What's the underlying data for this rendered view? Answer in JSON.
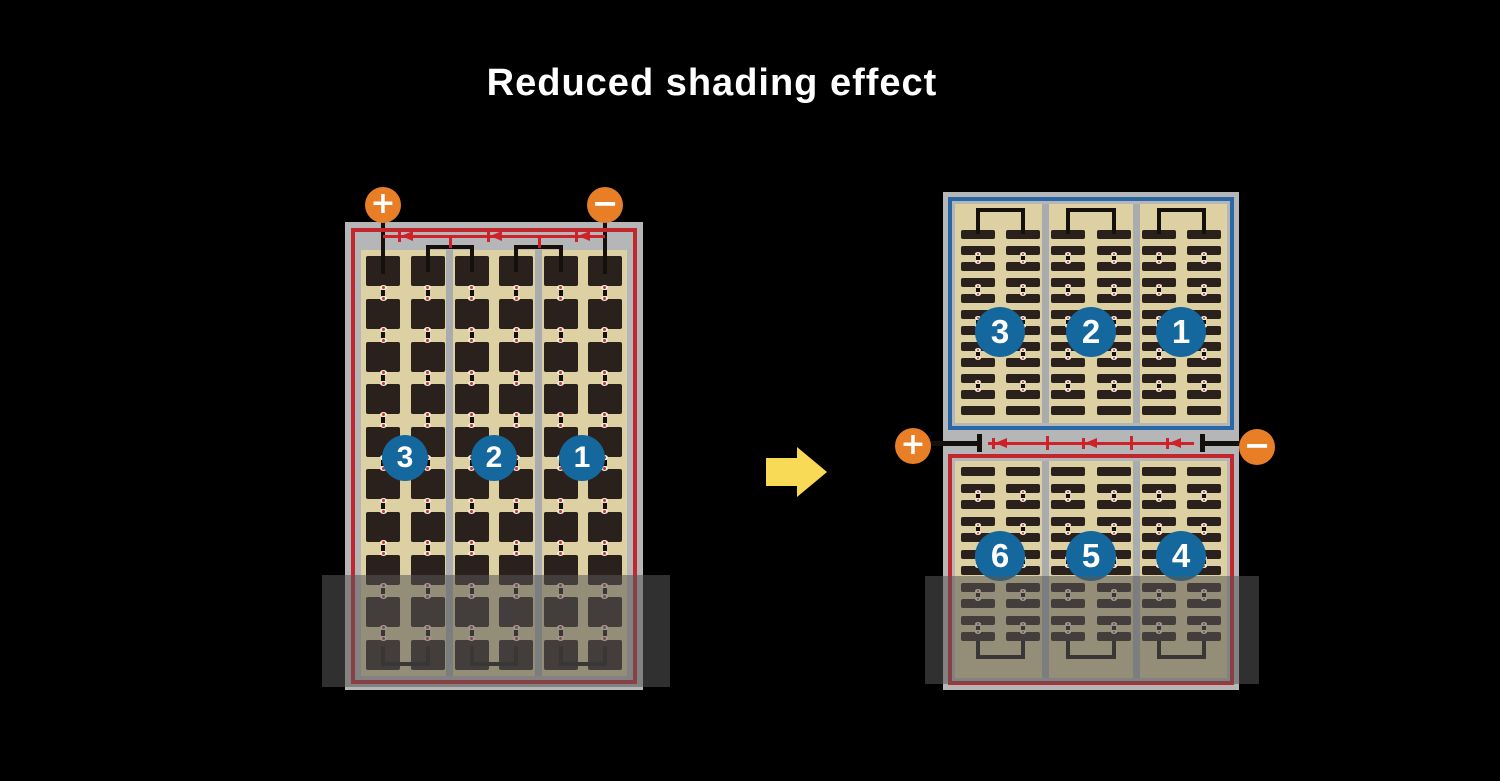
{
  "title": "Reduced shading effect",
  "before": {
    "name": "conventional full-cell module",
    "sections": [
      {
        "label": "3"
      },
      {
        "label": "2"
      },
      {
        "label": "1"
      }
    ],
    "terminals": {
      "positive": "+",
      "negative": "−"
    }
  },
  "after": {
    "name": "half-cut split module",
    "top_sections": [
      {
        "label": "3"
      },
      {
        "label": "2"
      },
      {
        "label": "1"
      }
    ],
    "bottom_sections": [
      {
        "label": "6"
      },
      {
        "label": "5"
      },
      {
        "label": "4"
      }
    ],
    "terminals": {
      "positive": "+",
      "negative": "−"
    }
  },
  "panels": {
    "before": {
      "columns": 6,
      "rows": 10
    },
    "after_top": {
      "columns": 6,
      "rows": 12
    },
    "after_bottom": {
      "columns": 6,
      "rows": 11
    }
  },
  "colors": {
    "background": "#000000",
    "frame_gray": "#b5b6b8",
    "panel_tan": "#ddd0a2",
    "cell_dark": "#2a211c",
    "border_red": "#c1272d",
    "border_blue": "#2a67a5",
    "bus_red": "#cf2128",
    "circle_blue": "#15689d",
    "terminal_orange": "#e87e26",
    "arrow_yellow": "#f8da56",
    "wire_black": "#15100c",
    "shade": "rgba(88,88,88,0.55)"
  },
  "icons": {
    "terminal_positive": "plus-icon",
    "terminal_negative": "minus-icon",
    "bypass_diode": "diode-left-icon",
    "transform_arrow": "right-arrow-icon"
  }
}
